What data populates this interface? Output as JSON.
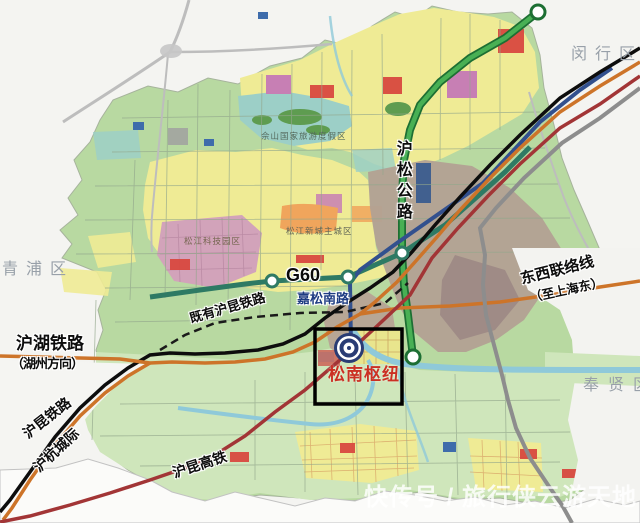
{
  "districts": [
    {
      "id": "minhang",
      "label": "闵行区"
    },
    {
      "id": "qingpu",
      "label": "青浦区"
    },
    {
      "id": "fengxian",
      "label": "奉贤区"
    }
  ],
  "areas": [
    {
      "id": "sheshan_resort",
      "label": "佘山国家旅游度假区"
    },
    {
      "id": "songjiang_newtown",
      "label": "松江新城主城区"
    },
    {
      "id": "songjiang_tech",
      "label": "松江科技园区"
    }
  ],
  "roads": [
    {
      "id": "g60",
      "label": "G60",
      "color": "#2e7a64"
    },
    {
      "id": "husong_road",
      "label": "沪松公路",
      "color": "#3da14b"
    },
    {
      "id": "jiasong_road",
      "label": "嘉松南路",
      "color": "#32508e"
    }
  ],
  "railways": [
    {
      "id": "existing_hukun",
      "label": "既有沪昆铁路",
      "style": "dashed",
      "color": "#1a1a1a"
    },
    {
      "id": "huhu_rail",
      "label": "沪湖铁路",
      "direction_note": "（湖州方向）",
      "color": "#111111"
    },
    {
      "id": "hukun_rail",
      "label": "沪昆铁路",
      "color": "#111111"
    },
    {
      "id": "huhang_intercity",
      "label": "沪杭城际",
      "color": "#cd7429"
    },
    {
      "id": "hukun_hsr",
      "label": "沪昆高铁",
      "color": "#a23536"
    },
    {
      "id": "east_west_link",
      "label": "东西联络线",
      "direction_note": "（至上海东）",
      "color": "#cd7429"
    }
  ],
  "hub": {
    "label": "松南枢纽",
    "box_color": "#000000",
    "label_color": "#cb3023"
  },
  "watermark": {
    "text": "快传号 / 旅行侠云游天地"
  },
  "colors": {
    "base_green": "#b8d9a1",
    "south_green": "#cfe6bb",
    "landuse_yellow": "#efeb95",
    "water_teal": "#9ccfc7",
    "river_blue": "#8fc9d9",
    "tech_pink": "#d2a3ba",
    "built_brown": "#b2a194",
    "highway_gray": "#8d8d8d",
    "hub_ring_navy": "#2a3c74"
  }
}
